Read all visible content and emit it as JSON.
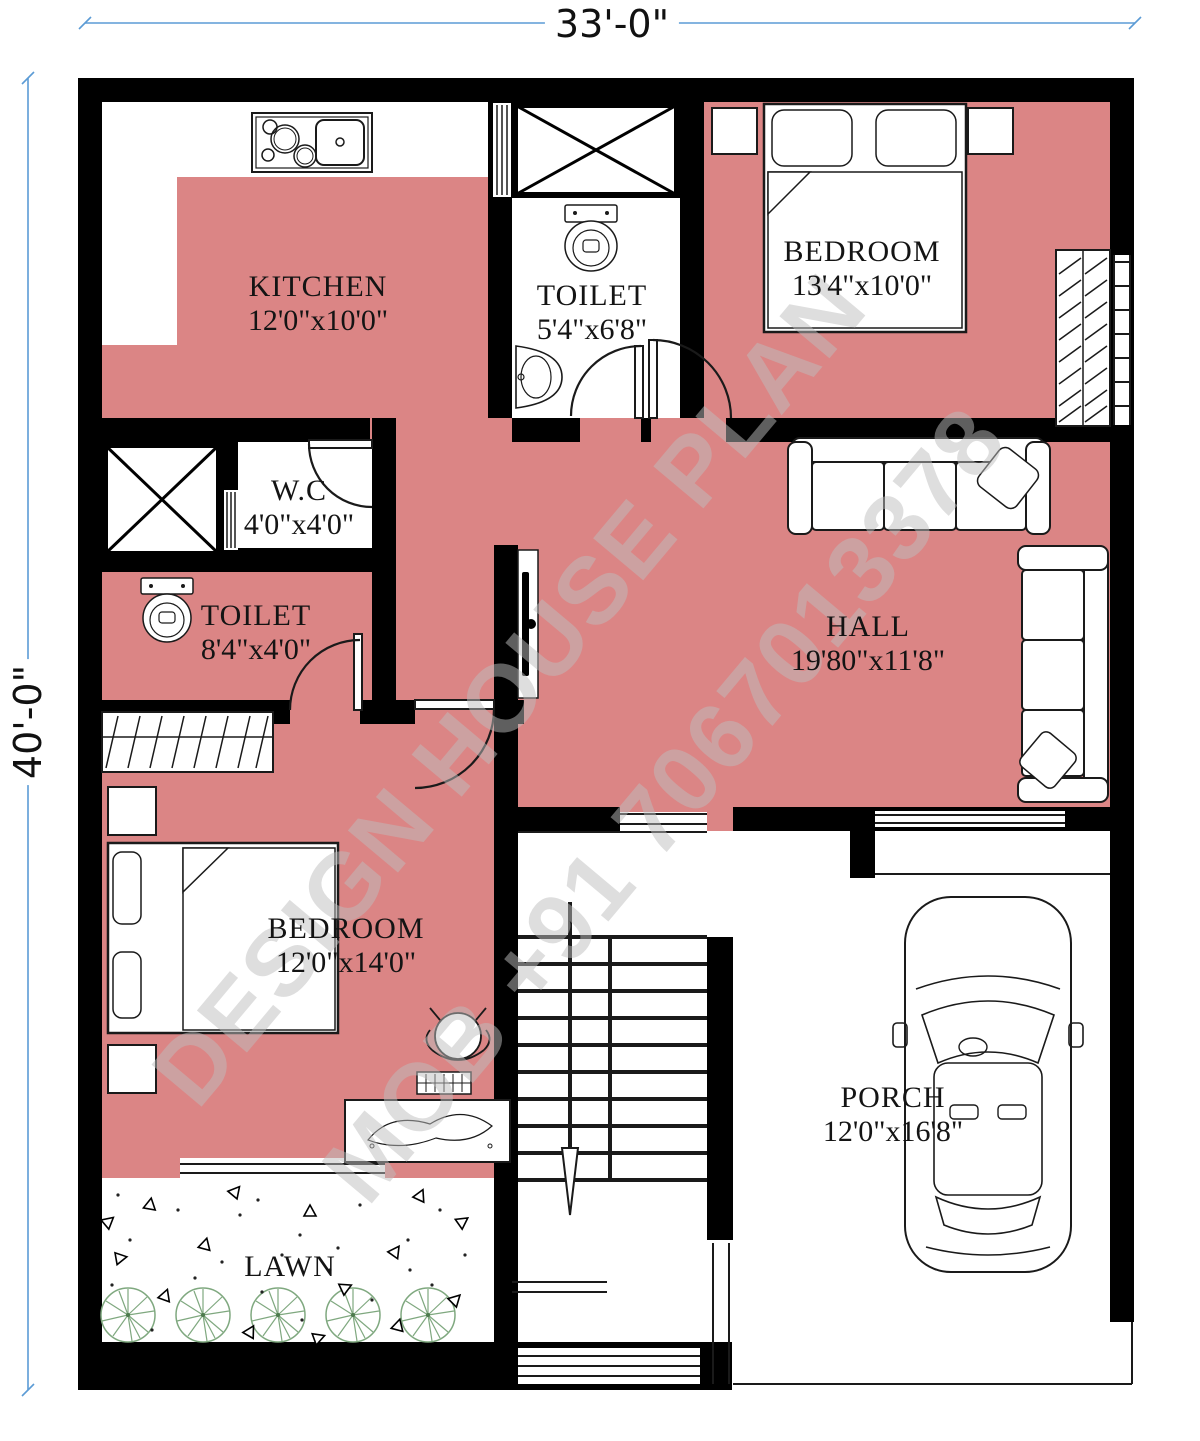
{
  "plan": {
    "dimensions": {
      "width_label": "33'-0\"",
      "height_label": "40'-0\""
    },
    "rooms": {
      "kitchen": {
        "name": "KITCHEN",
        "size": "12'0\"x10'0\""
      },
      "toilet_top": {
        "name": "TOILET",
        "size": "5'4\"x6'8\""
      },
      "bedroom_top": {
        "name": "BEDROOM",
        "size": "13'4\"x10'0\""
      },
      "wc": {
        "name": "W.C",
        "size": "4'0\"x4'0\""
      },
      "toilet_left": {
        "name": "TOILET",
        "size": "8'4\"x4'0\""
      },
      "hall": {
        "name": "HALL",
        "size": "19'80\"x11'8\""
      },
      "bedroom_bottom": {
        "name": "BEDROOM",
        "size": "12'0\"x14'0\""
      },
      "porch": {
        "name": "PORCH",
        "size": "12'0\"x16'8\""
      },
      "lawn": {
        "name": "LAWN"
      }
    },
    "watermark": {
      "line1": "DESIGN HOUSE PLAN",
      "line2": "MOB +91 7067013378"
    },
    "colors": {
      "floor": "#DB8585",
      "wall": "#000000",
      "dimension_line": "#5B9BD5",
      "tree": "#7FA87F",
      "watermark": "#BEBEBE"
    }
  }
}
